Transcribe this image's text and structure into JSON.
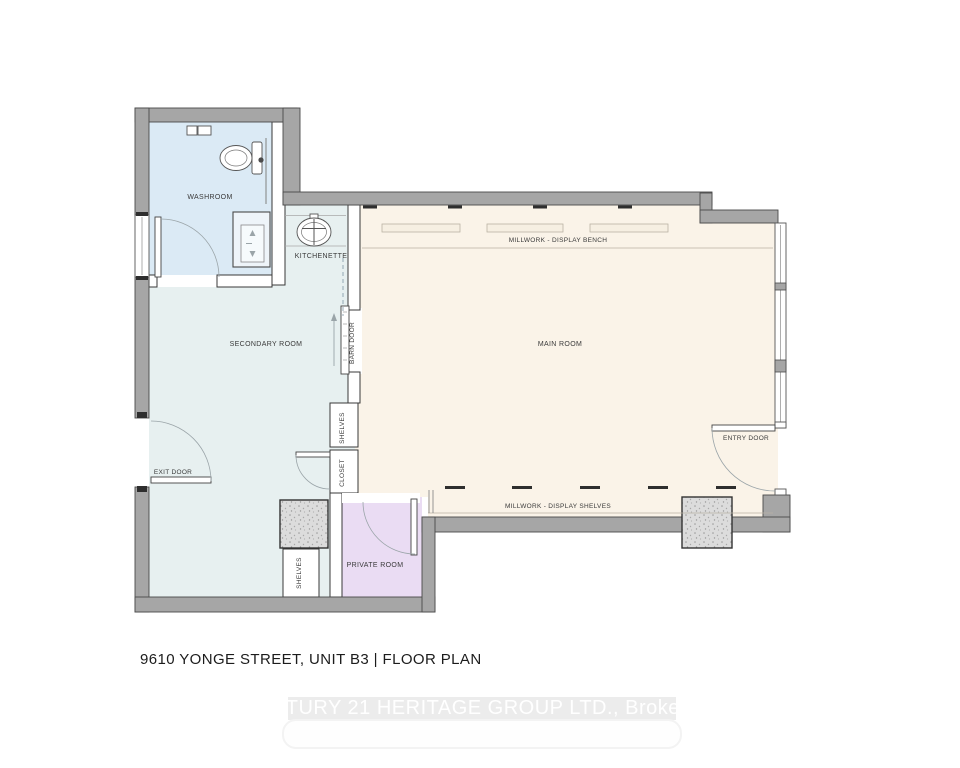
{
  "page": {
    "title": "9610 YONGE STREET, UNIT B3 | FLOOR PLAN",
    "watermark": "CENTURY 21 HERITAGE GROUP LTD., Brokerage"
  },
  "rooms": {
    "washroom": "WASHROOM",
    "kitchenette": "KITCHENETTE",
    "secondary_room": "SECONDARY ROOM",
    "main_room": "MAIN ROOM",
    "private_room": "PRIVATE ROOM"
  },
  "features": {
    "millwork_bench": "MILLWORK - DISPLAY BENCH",
    "millwork_shelves": "MILLWORK - DISPLAY SHELVES",
    "barn_door": "BARN DOOR",
    "entry_door": "ENTRY DOOR",
    "exit_door": "EXIT DOOR",
    "closet": "CLOSET",
    "shelves_top": "SHELVES",
    "shelves_bottom": "SHELVES"
  },
  "colors": {
    "washroom": "#dbeaf5",
    "secondary_room": "#e7f0f0",
    "main_room": "#faf3e8",
    "private_room": "#eadcf3",
    "wall": "#a6a6a6",
    "column": "#dcdcdc",
    "label": "#3a3a3a"
  }
}
